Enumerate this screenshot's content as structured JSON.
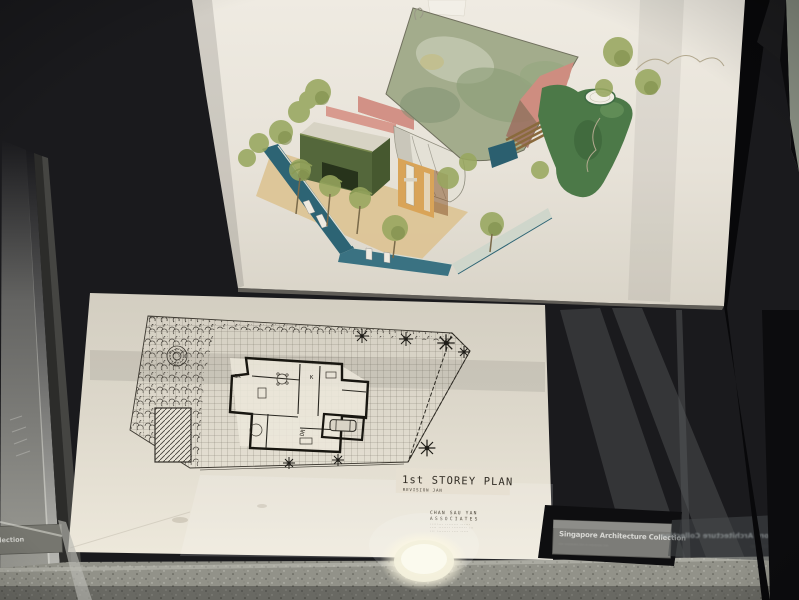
{
  "scene": {
    "subject": "architectural drawings in museum display case",
    "colors": {
      "backdrop": "#17171a",
      "paper": "#e9e5db",
      "plan_paper": "#ddd8cb",
      "floor": "#929289",
      "plaque": "#7c7c78"
    }
  },
  "watercolor": {
    "name": "axonometric watercolor rendering of house with garden",
    "colors": {
      "roof": "#a3ac8c",
      "gable": "#cf8e82",
      "green_volume": "#54673b",
      "teal_wall": "#2d6474",
      "courtyard_wall": "#d9a458",
      "ground": "#dcc394",
      "hedge": "#4c7948",
      "foliage": "#98a75f"
    }
  },
  "plan": {
    "title": "1st STOREY PLAN",
    "subtitle": "REVISION JAN",
    "room_labels": {
      "gr": "GR",
      "k": "K",
      "dr": "DR"
    },
    "stamp": {
      "line1": "CHAN SAU YAN",
      "line2": "ASSOCIATES",
      "line3": "········ ········ ······",
      "line4": "···· ······· ········· ···",
      "line5": "··· ········ ···· ·····"
    }
  },
  "plaques": {
    "main": {
      "title": "Singapore Architecture Collection",
      "subtitle": "···· ··········· ···· ·· ··········· ····"
    },
    "left_partial": "hitecture Collection",
    "reflection": "Singapore Architecture Collection",
    "reflection_subtitle": "··· ········ ····· ·· ·········"
  }
}
